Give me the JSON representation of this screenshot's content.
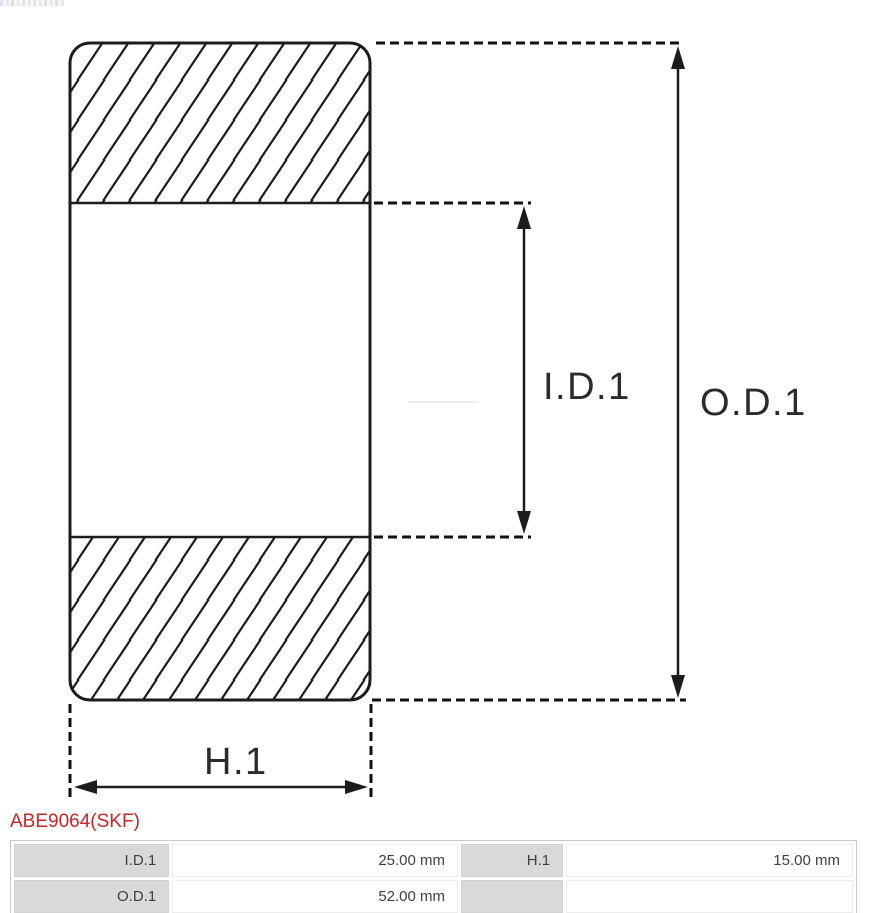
{
  "diagram": {
    "inner_diameter_label": "I.D.1",
    "outer_diameter_label": "O.D.1",
    "height_label": "H.1"
  },
  "part_number": "ABE9064(SKF)",
  "spec_table": {
    "rows": [
      [
        "I.D.1",
        "25.00 mm",
        "H.1",
        "15.00 mm"
      ],
      [
        "O.D.1",
        "52.00 mm",
        "",
        ""
      ]
    ]
  },
  "colors": {
    "accent_red": "#c92227",
    "drawing_line": "#1c1c1c",
    "label_cell_background": "#d9d9d9",
    "table_border": "#c9c9c9",
    "table_text": "#3f3f3f"
  }
}
